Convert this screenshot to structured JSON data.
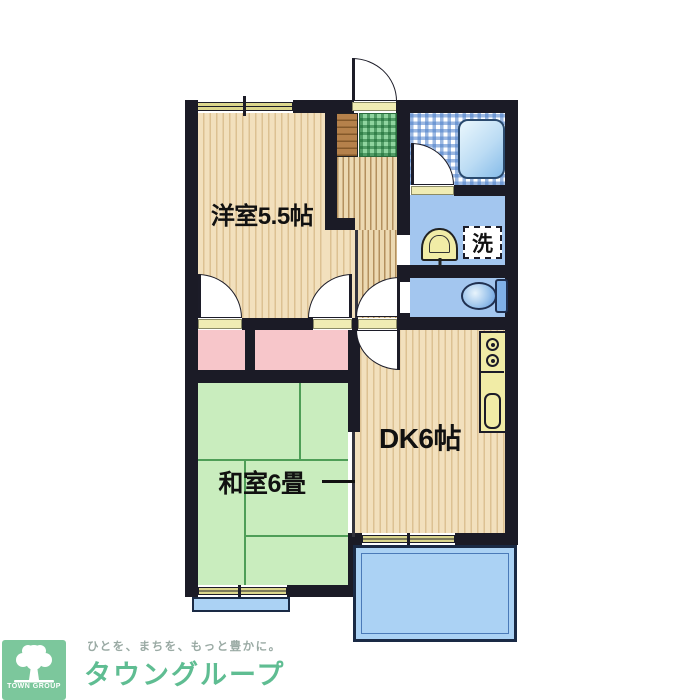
{
  "colors": {
    "wall": "#1b1b26",
    "wood_floor": "#f2e0bd",
    "wood_stripe": "#dcc192",
    "corridor_floor": "#ecd9b2",
    "corridor_stripe": "#b3905e",
    "tatami": "#c9edbe",
    "tatami_line": "#4e9e57",
    "closet": "#f7c6ca",
    "water_floor": "#a3c6ef",
    "balcony": "#abd2f4",
    "balcony_border": "#1a2a45",
    "window": "#dbd68c",
    "threshold": "#f0ecb4",
    "fixture_yellow": "#f1eca6",
    "genkan_mat": "#8fd49f",
    "cabinet": "#b5814b",
    "brand_green": "#5fbd92",
    "logo_bg": "#7cc79c",
    "tagline_gray": "#9aaaa4"
  },
  "rooms": {
    "western": {
      "label": "洋室5.5帖"
    },
    "dk": {
      "label": "DK6帖"
    },
    "japanese": {
      "label": "和室6畳"
    }
  },
  "fixtures": {
    "laundry": "洗"
  },
  "logo": {
    "tagline": "ひとを、まちを、もっと豊かに。",
    "brand": "タウングループ",
    "mark_text": "TOWN GROUP"
  }
}
